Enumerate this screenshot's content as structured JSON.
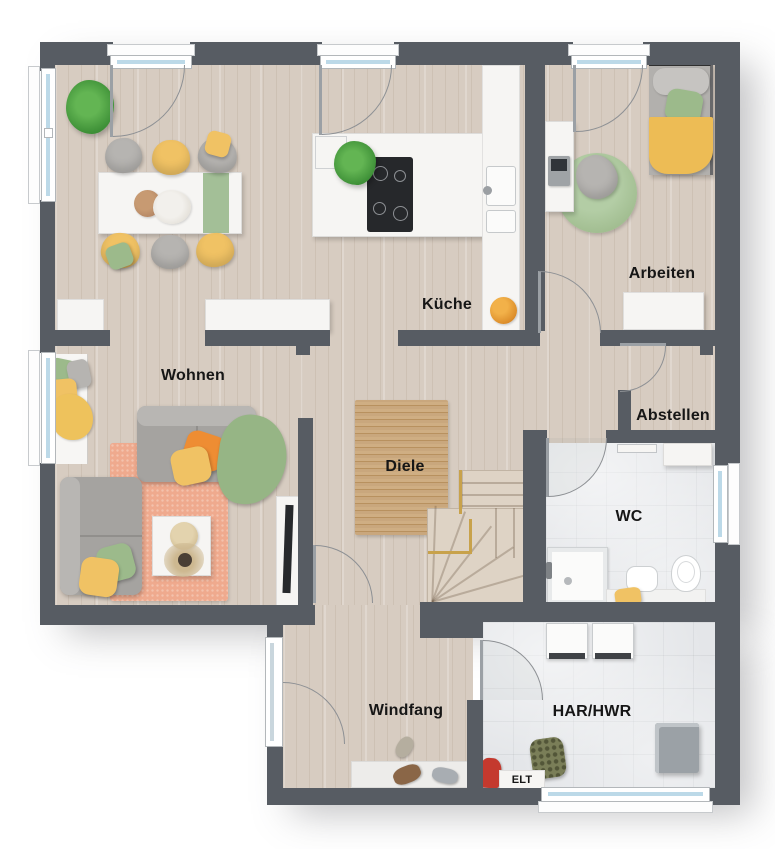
{
  "floorplan": {
    "rooms": {
      "wohnen": {
        "label": "Wohnen"
      },
      "kueche": {
        "label": "Küche"
      },
      "arbeiten": {
        "label": "Arbeiten"
      },
      "abstellen": {
        "label": "Abstellen"
      },
      "diele": {
        "label": "Diele"
      },
      "wc": {
        "label": "WC"
      },
      "windfang": {
        "label": "Windfang"
      },
      "har_hwr": {
        "label": "HAR/HWR"
      },
      "elt": {
        "label": "ELT"
      }
    },
    "colors": {
      "wall": "#575c63",
      "wood_floor": "#d7ccc1",
      "tile_floor": "#e4e6e9",
      "glass": "#bcd9e8",
      "accent_yellow": "#f0c264",
      "accent_green": "#9cba8b",
      "accent_orange": "#ee8d33",
      "rug_peach": "#efaa8e",
      "rug_jute": "#c2a077",
      "handrail_gold": "#c8a24b",
      "sofa_gray": "#a5a3a0",
      "cooktop_black": "#26282b"
    }
  }
}
